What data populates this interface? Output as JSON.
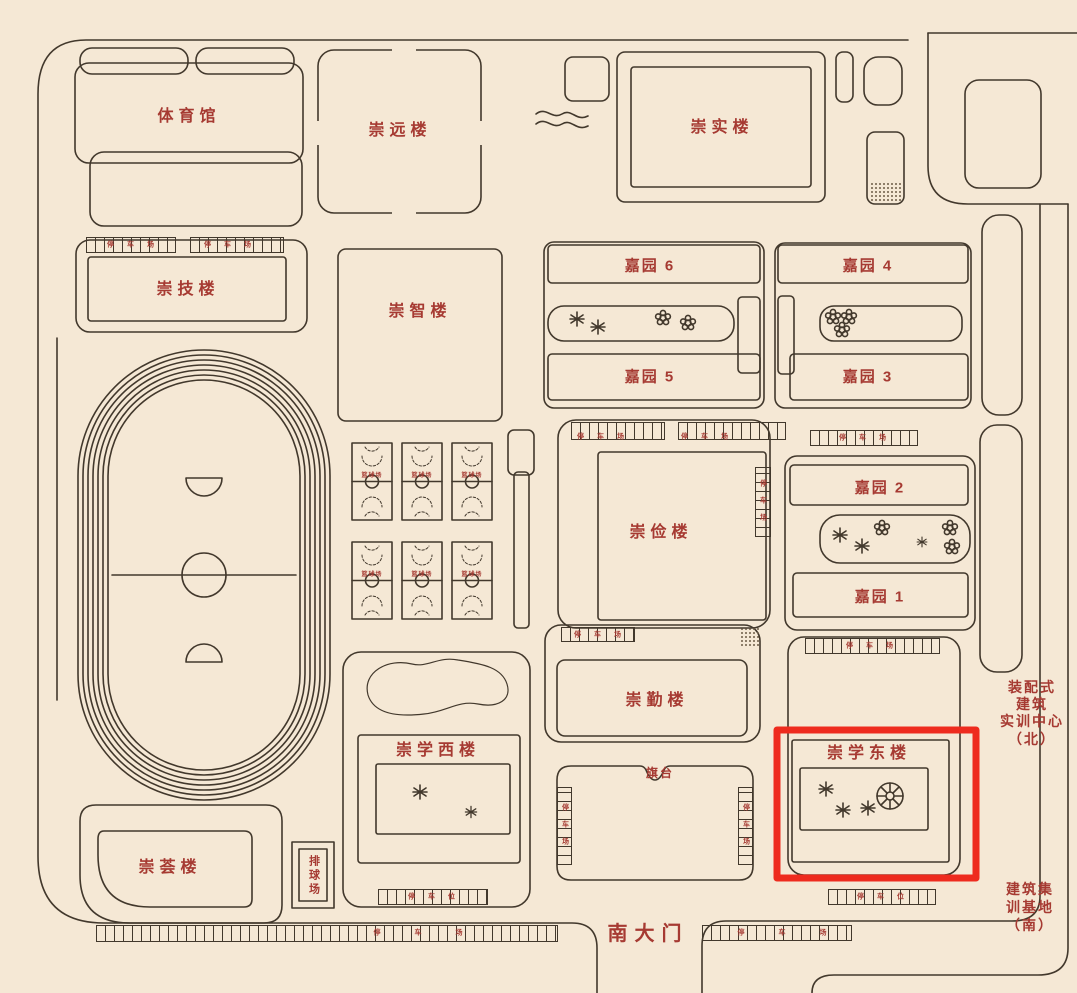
{
  "map": {
    "colors": {
      "bg": "#f5e8d5",
      "line": "#42382c",
      "red": "#a63a32",
      "highlight": "#ee2b1e"
    },
    "highlight": {
      "target": "崇学东楼"
    },
    "buildings": {
      "gymnasium": "体育馆",
      "chongyuan": "崇远楼",
      "chongshi": "崇实楼",
      "chongji": "崇技楼",
      "chongzhi": "崇智楼",
      "chongjian": "崇俭楼",
      "chongqin": "崇勤楼",
      "chongxue_west": "崇学西楼",
      "chongxue_east": "崇学东楼",
      "chonghui": "崇荟楼",
      "jiayuan6": "嘉园 6",
      "jiayuan5": "嘉园 5",
      "jiayuan4": "嘉园 4",
      "jiayuan3": "嘉园 3",
      "jiayuan2": "嘉园 2",
      "jiayuan1": "嘉园 1"
    },
    "facilities": {
      "basketball": "篮球场",
      "volleyball": "排球场",
      "flag_platform": "旗台",
      "south_gate": "南大门",
      "parking_lot": "停车场",
      "parking_space": "停车位"
    },
    "annotations": {
      "training_center_north": [
        "装配式",
        "建筑",
        "实训中心",
        "（北）"
      ],
      "training_base_south": [
        "建筑集",
        "训基地",
        "（南）"
      ]
    }
  }
}
